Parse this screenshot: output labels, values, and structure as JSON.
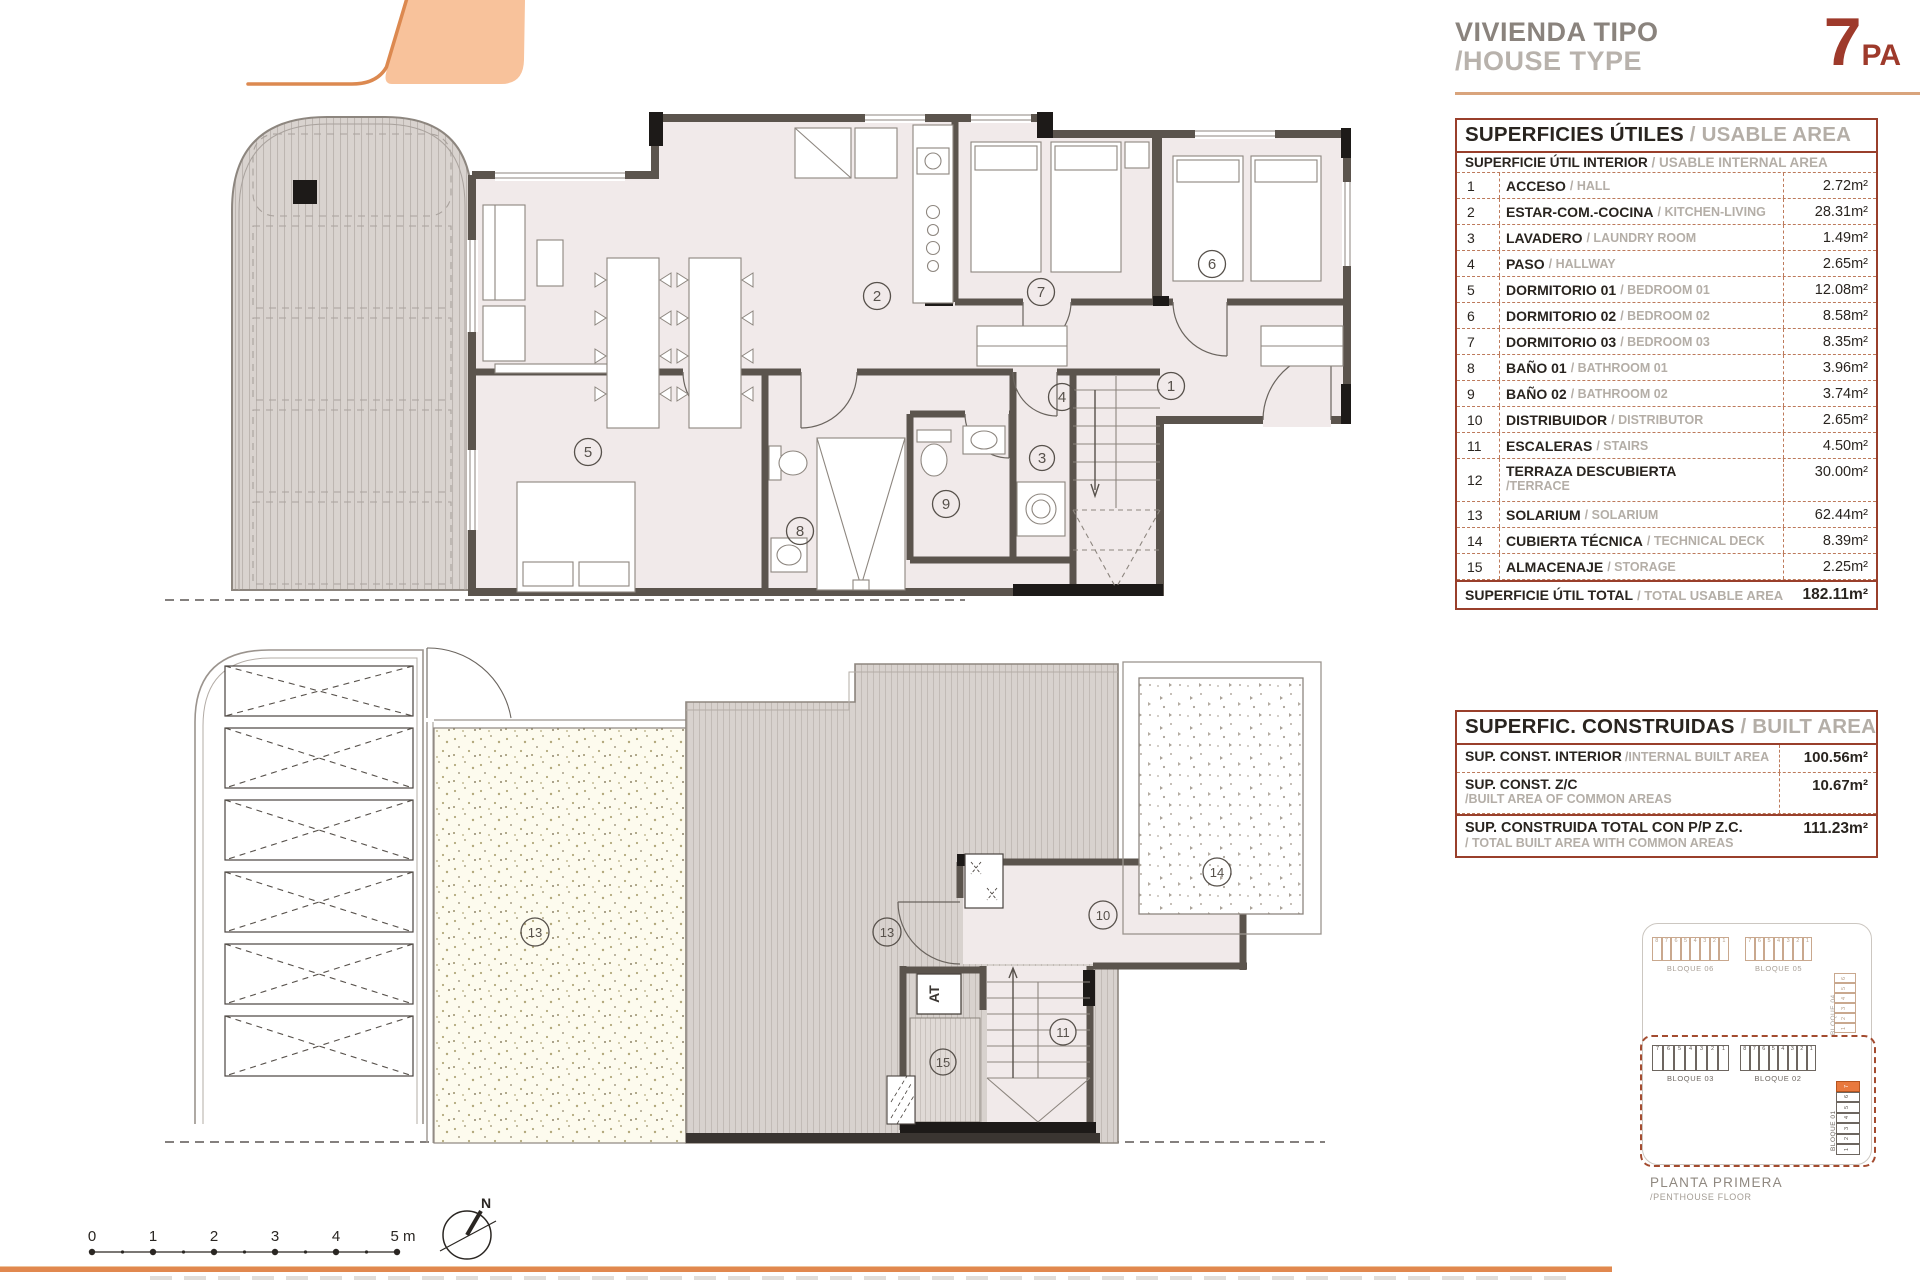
{
  "header": {
    "title_es": "VIVIENDA TIPO",
    "title_en": "/HOUSE TYPE",
    "type_number": "7",
    "type_suffix": "PA"
  },
  "tables": {
    "usable": {
      "title_es": "SUPERFICIES ÚTILES",
      "title_en": "/ USABLE AREA",
      "sub_es": "SUPERFICIE ÚTIL INTERIOR",
      "sub_en": "/ USABLE INTERNAL AREA",
      "rows": [
        {
          "num": "1",
          "name_es": "ACCESO",
          "name_en": "/ HALL",
          "area": "2.72m²"
        },
        {
          "num": "2",
          "name_es": "ESTAR-COM.-COCINA",
          "name_en": "/ KITCHEN-LIVING",
          "area": "28.31m²"
        },
        {
          "num": "3",
          "name_es": "LAVADERO",
          "name_en": "/ LAUNDRY ROOM",
          "area": "1.49m²"
        },
        {
          "num": "4",
          "name_es": "PASO",
          "name_en": "/ HALLWAY",
          "area": "2.65m²"
        },
        {
          "num": "5",
          "name_es": "DORMITORIO 01",
          "name_en": "/ BEDROOM 01",
          "area": "12.08m²"
        },
        {
          "num": "6",
          "name_es": "DORMITORIO 02",
          "name_en": "/ BEDROOM 02",
          "area": "8.58m²"
        },
        {
          "num": "7",
          "name_es": "DORMITORIO 03",
          "name_en": "/ BEDROOM 03",
          "area": "8.35m²"
        },
        {
          "num": "8",
          "name_es": "BAÑO 01",
          "name_en": "/ BATHROOM 01",
          "area": "3.96m²"
        },
        {
          "num": "9",
          "name_es": "BAÑO 02",
          "name_en": "/ BATHROOM 02",
          "area": "3.74m²"
        },
        {
          "num": "10",
          "name_es": "DISTRIBUIDOR",
          "name_en": "/ DISTRIBUTOR",
          "area": "2.65m²"
        },
        {
          "num": "11",
          "name_es": "ESCALERAS",
          "name_en": "/ STAIRS",
          "area": "4.50m²"
        },
        {
          "num": "12",
          "name_es": "TERRAZA DESCUBIERTA",
          "name_en": "/TERRACE",
          "area": "30.00m²",
          "row_class": "stack"
        },
        {
          "num": "13",
          "name_es": "SOLARIUM",
          "name_en": "/ SOLARIUM",
          "area": "62.44m²"
        },
        {
          "num": "14",
          "name_es": "CUBIERTA TÉCNICA",
          "name_en": "/ TECHNICAL DECK",
          "area": "8.39m²"
        },
        {
          "num": "15",
          "name_es": "ALMACENAJE",
          "name_en": "/ STORAGE",
          "area": "2.25m²"
        }
      ],
      "total_es": "SUPERFICIE ÚTIL TOTAL",
      "total_en": "/ TOTAL USABLE AREA",
      "total_area": "182.11m²"
    },
    "built": {
      "title_es": "SUPERFIC. CONSTRUIDAS",
      "title_en": "/ BUILT AREA",
      "rows": [
        {
          "name_es": "SUP. CONST. INTERIOR",
          "name_en": "/INTERNAL BUILT AREA",
          "area": "100.56m²"
        },
        {
          "name_es": "SUP. CONST. Z/C",
          "name_en": "/BUILT AREA OF COMMON AREAS",
          "area": "10.67m²",
          "row_class": "stack"
        }
      ],
      "total_es": "SUP. CONSTRUIDA TOTAL CON P/P Z.C.",
      "total_en": "/ TOTAL BUILT AREA WITH COMMON AREAS",
      "total_area": "111.23m²"
    }
  },
  "plans": {
    "upper_rooms": [
      "1",
      "2",
      "3",
      "4",
      "5",
      "6",
      "7",
      "8",
      "9"
    ],
    "lower_rooms": [
      "13",
      "13",
      "10",
      "11",
      "14",
      "15"
    ],
    "at_label": "AT"
  },
  "key_plan": {
    "blocks": {
      "b06": {
        "label": "BLOQUE 06",
        "cells": [
          {
            "n": "8"
          },
          {
            "n": "7"
          },
          {
            "n": "6"
          },
          {
            "n": "5"
          },
          {
            "n": "4"
          },
          {
            "n": "3"
          },
          {
            "n": "2"
          },
          {
            "n": "1"
          }
        ]
      },
      "b05": {
        "label": "BLOQUE 05",
        "cells": [
          {
            "n": "7"
          },
          {
            "n": "6"
          },
          {
            "n": "5"
          },
          {
            "n": "4"
          },
          {
            "n": "3"
          },
          {
            "n": "2"
          },
          {
            "n": "1"
          }
        ]
      },
      "b04": {
        "label": "BLOQUE 04",
        "cells": [
          {
            "n": "6"
          },
          {
            "n": "5"
          },
          {
            "n": "4"
          },
          {
            "n": "3"
          },
          {
            "n": "2"
          },
          {
            "n": "1"
          }
        ]
      },
      "b03": {
        "label": "BLOQUE 03",
        "cells": [
          {
            "n": "7"
          },
          {
            "n": "6"
          },
          {
            "n": "5"
          },
          {
            "n": "4"
          },
          {
            "n": "3"
          },
          {
            "n": "2"
          },
          {
            "n": "1"
          }
        ]
      },
      "b02": {
        "label": "BLOQUE 02",
        "cells": [
          {
            "n": "8"
          },
          {
            "n": "7"
          },
          {
            "n": "6"
          },
          {
            "n": "5"
          },
          {
            "n": "4"
          },
          {
            "n": "3"
          },
          {
            "n": "2"
          },
          {
            "n": "1"
          }
        ]
      },
      "b01": {
        "label": "BLOQUE 01",
        "cells": [
          {
            "n": "7",
            "cls": "hl"
          },
          {
            "n": "6"
          },
          {
            "n": "5"
          },
          {
            "n": "4"
          },
          {
            "n": "3"
          },
          {
            "n": "2"
          },
          {
            "n": "1"
          }
        ]
      }
    },
    "floor_es": "PLANTA PRIMERA",
    "floor_en": "/PENTHOUSE FLOOR"
  },
  "scale_bar": {
    "labels": [
      "0",
      "1",
      "2",
      "3",
      "4",
      "5 m"
    ]
  },
  "compass": {
    "north_label": "N"
  }
}
